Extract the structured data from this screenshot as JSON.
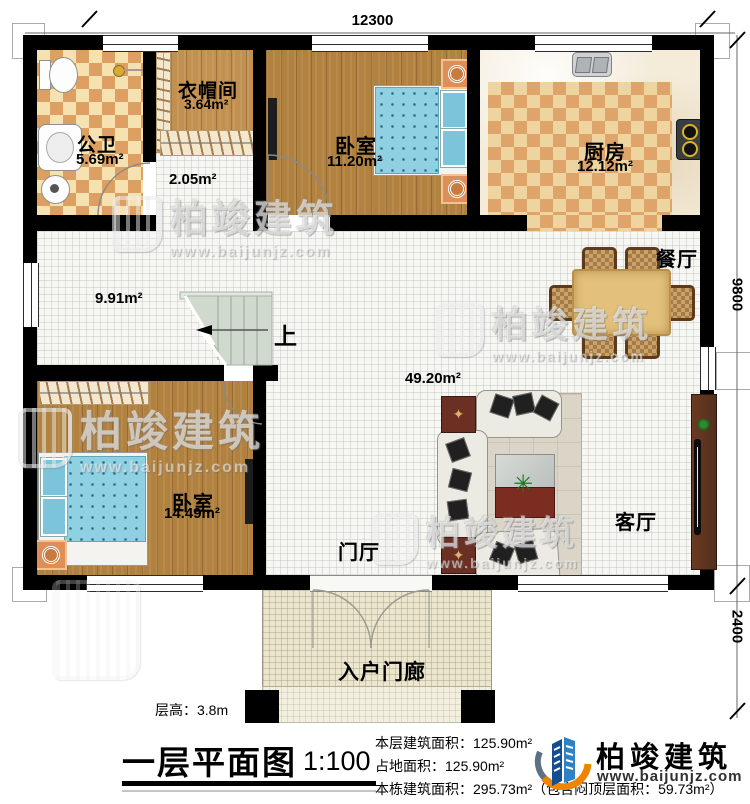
{
  "plan": {
    "title": "一层平面图",
    "scale": "1:100",
    "floor_height": "层高：3.8m",
    "stairs_up": "上",
    "dimensions": {
      "width_top": "12300",
      "height_right": "9800",
      "porch_depth_right": "2400"
    }
  },
  "rooms": {
    "bathroom": {
      "name": "公卫",
      "area": "5.69m²"
    },
    "cloakroom": {
      "name": "衣帽间",
      "area": "3.64m²"
    },
    "corridor": {
      "area": "2.05m²"
    },
    "bedroom_top": {
      "name": "卧室",
      "area": "11.20m²"
    },
    "kitchen": {
      "name": "厨房",
      "area": "12.12m²"
    },
    "hallway": {
      "area": "9.91m²"
    },
    "great_room": {
      "area": "49.20m²"
    },
    "dining": {
      "name": "餐厅"
    },
    "living": {
      "name": "客厅"
    },
    "foyer": {
      "name": "门厅"
    },
    "bedroom_bottom": {
      "name": "卧室",
      "area": "14.49m²"
    },
    "porch": {
      "name": "入户门廊"
    }
  },
  "stats": {
    "floor_area": "本层建筑面积：125.90m²",
    "land_area": "占地面积：125.90m²",
    "building_area": "本栋建筑面积：295.73m²（包含闷顶层面积：59.73m²）"
  },
  "brand": {
    "name": "柏竣建筑",
    "website": "www.baijunjz.com"
  },
  "watermark": {
    "name": "柏竣建筑",
    "website": "www.baijunjz.com"
  },
  "colors": {
    "wall": "#000000",
    "checker_dark": "#dd9f62",
    "checker_light": "#f6e2b0",
    "wood": "#b1813f",
    "tile": "#f6f6f3",
    "porch": "#ebe6cd",
    "stair": "#cfd9cd",
    "bed_blue": "#8fd0e2",
    "dining_table": "#e3c17c",
    "brand_blue": "#1c5fa9",
    "brand_orange": "#f08300"
  }
}
